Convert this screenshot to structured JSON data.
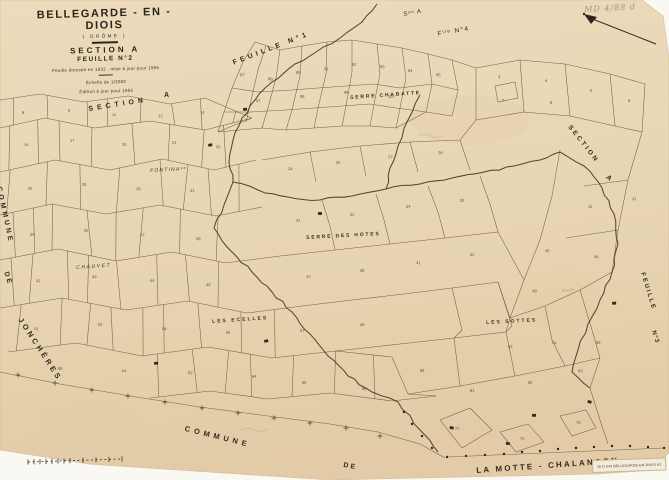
{
  "map": {
    "title": "BELLEGARDE - EN - DIOIS",
    "subtitle": "( DRÔME )",
    "section_line": "SECTION A",
    "sheet_line": "FEUILLE N°2",
    "note1": "Feuille dressée en 1832 , mise à jour pour 1965",
    "note2": "Échelle de 1/2500",
    "note3": "Édition à jour pour 1962",
    "handwritten_note": "MD 4/88 d",
    "stamp": "26 D 043   BELLEGARDE-EN-DIOIS   A2"
  },
  "edge_labels": {
    "top_section": "Sᵒⁿ A",
    "top_sheet": "Fˡˡᵉ N°4",
    "sheet1": "FEUILLE N°1",
    "section_left": "SECTION",
    "section_left_a": "A",
    "section_right": "SECTION",
    "section_right_a": "A",
    "sheet3_word": "FEUILLE",
    "sheet3_no": "N°3",
    "commune_left": "COMMUNE",
    "de_left": "DE",
    "joncheres": "JONCHÈRES",
    "commune_bottom": "COMMUNE",
    "de_bottom": "DE",
    "la_motte": "LA MOTTE - CHALANCON"
  },
  "place_names": [
    {
      "label": "SERRE CHABATTE",
      "x": 350,
      "y": 95,
      "rot": -4,
      "size": 5,
      "ls": 1.8,
      "style": "caps"
    },
    {
      "label": "FONTINAˢᵉ",
      "x": 150,
      "y": 168,
      "rot": -3,
      "size": 5,
      "ls": 1.2,
      "style": "it"
    },
    {
      "label": "SERRE DES HOTES",
      "x": 306,
      "y": 235,
      "rot": -3,
      "size": 5,
      "ls": 1.8,
      "style": "caps"
    },
    {
      "label": "CHAUVET",
      "x": 76,
      "y": 265,
      "rot": -4,
      "size": 5,
      "ls": 1.6,
      "style": "it"
    },
    {
      "label": "LES ECELLES",
      "x": 212,
      "y": 319,
      "rot": -4,
      "size": 5,
      "ls": 2,
      "style": "caps"
    },
    {
      "label": "LES SOTTES",
      "x": 486,
      "y": 320,
      "rot": -3,
      "size": 5,
      "ls": 2,
      "style": "caps"
    },
    {
      "label": "Ravin",
      "x": 562,
      "y": 288,
      "rot": -6,
      "size": 4,
      "ls": 0.5,
      "style": "faint"
    }
  ],
  "parcel_numbers": [
    [
      22,
      114,
      "8"
    ],
    [
      68,
      112,
      "9"
    ],
    [
      112,
      116,
      "11"
    ],
    [
      158,
      117,
      "12"
    ],
    [
      200,
      114,
      "14"
    ],
    [
      24,
      146,
      "15"
    ],
    [
      70,
      142,
      "17"
    ],
    [
      122,
      146,
      "18"
    ],
    [
      172,
      144,
      "21"
    ],
    [
      216,
      148,
      "22"
    ],
    [
      28,
      190,
      "25"
    ],
    [
      82,
      186,
      "26"
    ],
    [
      136,
      190,
      "28"
    ],
    [
      190,
      192,
      "31"
    ],
    [
      30,
      236,
      "34"
    ],
    [
      84,
      232,
      "35"
    ],
    [
      140,
      236,
      "37"
    ],
    [
      196,
      240,
      "38"
    ],
    [
      36,
      282,
      "41"
    ],
    [
      92,
      278,
      "43"
    ],
    [
      150,
      282,
      "44"
    ],
    [
      206,
      286,
      "46"
    ],
    [
      34,
      330,
      "51"
    ],
    [
      98,
      326,
      "52"
    ],
    [
      162,
      330,
      "54"
    ],
    [
      226,
      334,
      "56"
    ],
    [
      58,
      370,
      "58"
    ],
    [
      122,
      372,
      "61"
    ],
    [
      188,
      374,
      "62"
    ],
    [
      252,
      378,
      "64"
    ],
    [
      240,
      76,
      "87"
    ],
    [
      268,
      80,
      "88"
    ],
    [
      296,
      74,
      "89"
    ],
    [
      324,
      70,
      "91"
    ],
    [
      352,
      66,
      "92"
    ],
    [
      380,
      68,
      "93"
    ],
    [
      408,
      72,
      "94"
    ],
    [
      436,
      76,
      "95"
    ],
    [
      256,
      102,
      "97"
    ],
    [
      300,
      98,
      "98"
    ],
    [
      344,
      94,
      "99"
    ],
    [
      388,
      98,
      "101"
    ],
    [
      498,
      78,
      "3"
    ],
    [
      545,
      82,
      "4"
    ],
    [
      590,
      92,
      "5"
    ],
    [
      628,
      102,
      "6"
    ],
    [
      502,
      102,
      "7"
    ],
    [
      550,
      104,
      "8"
    ],
    [
      288,
      170,
      "24"
    ],
    [
      336,
      164,
      "25"
    ],
    [
      388,
      158,
      "27"
    ],
    [
      438,
      154,
      "28"
    ],
    [
      296,
      222,
      "31"
    ],
    [
      350,
      216,
      "32"
    ],
    [
      406,
      208,
      "34"
    ],
    [
      460,
      202,
      "35"
    ],
    [
      306,
      278,
      "37"
    ],
    [
      360,
      272,
      "38"
    ],
    [
      416,
      264,
      "41"
    ],
    [
      470,
      256,
      "42"
    ],
    [
      588,
      208,
      "12"
    ],
    [
      632,
      200,
      "11"
    ],
    [
      545,
      252,
      "45"
    ],
    [
      594,
      258,
      "46"
    ],
    [
      532,
      292,
      "48"
    ],
    [
      508,
      348,
      "53"
    ],
    [
      552,
      344,
      "54"
    ],
    [
      596,
      344,
      "55"
    ],
    [
      470,
      392,
      "61"
    ],
    [
      528,
      384,
      "62"
    ],
    [
      578,
      372,
      "63"
    ],
    [
      455,
      430,
      "71"
    ],
    [
      520,
      440,
      "72"
    ],
    [
      576,
      424,
      "73"
    ],
    [
      300,
      332,
      "57"
    ],
    [
      360,
      326,
      "58"
    ],
    [
      302,
      384,
      "65"
    ],
    [
      362,
      390,
      "66"
    ],
    [
      420,
      372,
      "68"
    ]
  ],
  "colors": {
    "paper": "#e8d5b2",
    "ink": "#2e281f",
    "parcel_line": "#6d5a41",
    "stream": "#463726"
  }
}
